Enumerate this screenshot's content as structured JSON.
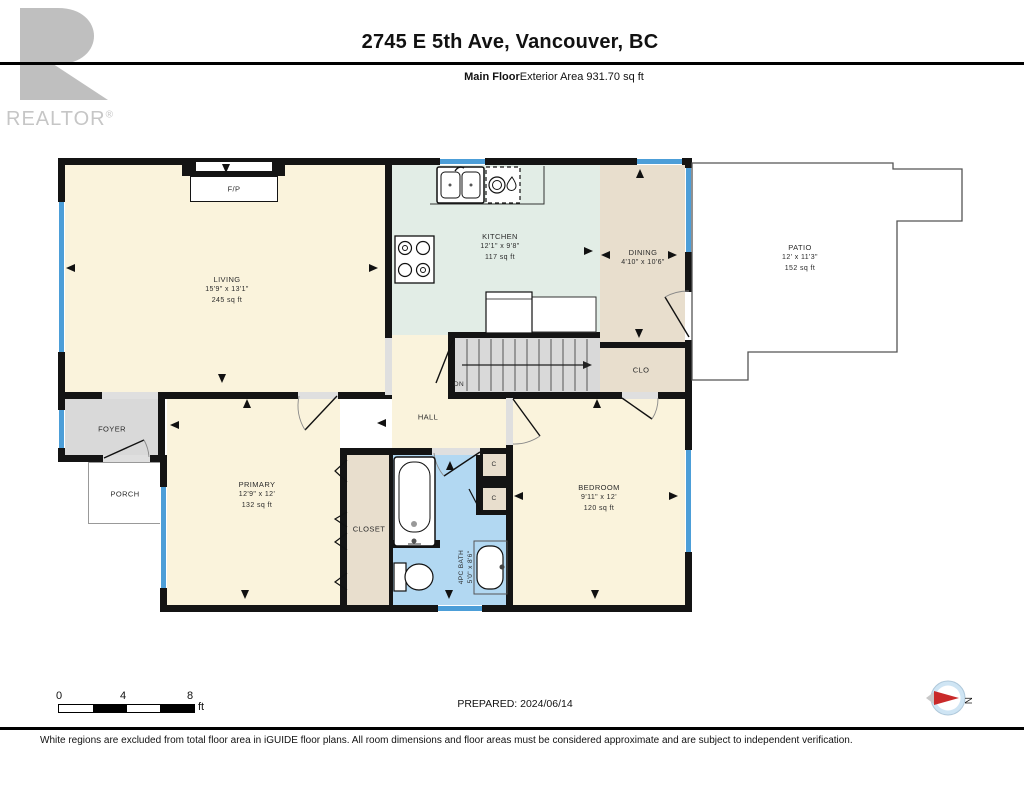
{
  "header": {
    "title": "2745 E 5th Ave, Vancouver, BC",
    "floor_label": "Main Floor",
    "area_label": "Exterior Area 931.70 sq ft",
    "logo_text": "REALTOR",
    "logo_reg": "®"
  },
  "rooms": {
    "living": {
      "name": "LIVING",
      "dims": "15'9\" x 13'1\"",
      "area": "245 sq ft"
    },
    "kitchen": {
      "name": "KITCHEN",
      "dims": "12'1\" x 9'8\"",
      "area": "117 sq ft"
    },
    "dining": {
      "name": "DINING",
      "dims": "4'10\" x 10'6\""
    },
    "patio": {
      "name": "PATIO",
      "dims": "12' x 11'3\"",
      "area": "152 sq ft"
    },
    "primary": {
      "name": "PRIMARY",
      "dims": "12'9\" x 12'",
      "area": "132 sq ft"
    },
    "bedroom": {
      "name": "BEDROOM",
      "dims": "9'11\" x 12'",
      "area": "120 sq ft"
    },
    "bath": {
      "name": "4PC BATH",
      "dims": "5'0\" x 8'6\""
    },
    "hall": {
      "name": "HALL"
    },
    "foyer": {
      "name": "FOYER"
    },
    "porch": {
      "name": "PORCH"
    },
    "closet": {
      "name": "CLOSET"
    },
    "clo": {
      "name": "CLO"
    },
    "closet_small_1": {
      "name": "C"
    },
    "closet_small_2": {
      "name": "C"
    },
    "fireplace": {
      "name": "F/P"
    },
    "stairs": {
      "label": "DN"
    }
  },
  "scale_bar": {
    "ticks": [
      "0",
      "4",
      "8"
    ],
    "unit": "ft"
  },
  "compass": {
    "north_label": "N"
  },
  "footer": {
    "prepared": "PREPARED: 2024/06/14",
    "disclaimer": "White regions are excluded from total floor area in iGUIDE floor plans. All room dimensions and floor areas must be considered approximate and are subject to independent verification."
  },
  "colors": {
    "room_cream": "#FAF3DC",
    "kitchen_green": "#E2EDE6",
    "dining_tan": "#E8DECD",
    "bath_blue": "#B2D8F2",
    "stairs_gray": "#D9D9D9",
    "window_blue": "#4C9ED8",
    "wall": "#141414",
    "compass_red": "#C92A2A",
    "logo_gray": "#BFBFBF"
  }
}
